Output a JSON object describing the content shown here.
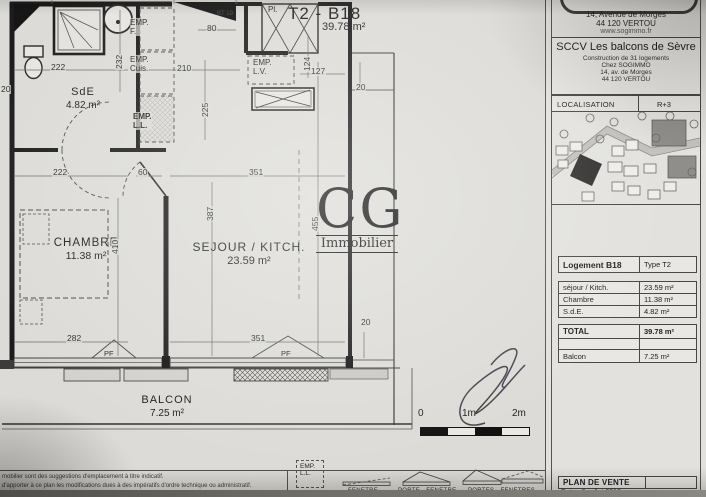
{
  "plan": {
    "title": "T2 - B18",
    "title_area": "39.78 m²",
    "rooms": {
      "sde_name": "SdE",
      "sde_area": "4.82 m²",
      "chambre_name": "CHAMBRE",
      "chambre_area": "11.38 m²",
      "sejour_name": "SEJOUR / KITCH.",
      "sejour_area": "23.59 m²",
      "balcon_name": "BALCON",
      "balcon_area": "7.25 m²"
    },
    "annotations": {
      "emp_f": "EMP.\nF.",
      "emp_cuis": "EMP.\nCuis.",
      "emp_ll": "EMP.\nL.L.",
      "emp_lv": "EMP.\nL.V.",
      "placard": "Pl.",
      "door_tag": "BT 19",
      "pf1": "PF",
      "pf2": "PF"
    },
    "dims": [
      {
        "t": "222",
        "x": 50,
        "y": 63
      },
      {
        "t": "210",
        "x": 176,
        "y": 64
      },
      {
        "t": "80",
        "x": 206,
        "y": 24
      },
      {
        "t": "225",
        "x": 201,
        "y": 118,
        "r": 1
      },
      {
        "t": "127",
        "x": 310,
        "y": 67
      },
      {
        "t": "124",
        "x": 303,
        "y": 72,
        "r": 1
      },
      {
        "t": "232",
        "x": 115,
        "y": 70,
        "r": 1
      },
      {
        "t": "20",
        "x": 0,
        "y": 85
      },
      {
        "t": "222",
        "x": 52,
        "y": 168
      },
      {
        "t": "60",
        "x": 137,
        "y": 168
      },
      {
        "t": "351",
        "x": 248,
        "y": 168
      },
      {
        "t": "410",
        "x": 111,
        "y": 255,
        "r": 1
      },
      {
        "t": "387",
        "x": 206,
        "y": 222,
        "r": 1
      },
      {
        "t": "455",
        "x": 311,
        "y": 232,
        "r": 1
      },
      {
        "t": "282",
        "x": 66,
        "y": 334
      },
      {
        "t": "351",
        "x": 250,
        "y": 334
      },
      {
        "t": "20",
        "x": 355,
        "y": 83
      },
      {
        "t": "20",
        "x": 360,
        "y": 318
      }
    ],
    "watermark": {
      "initials": "CG",
      "name": "Immobilier"
    },
    "scale": {
      "t0": "0",
      "t1": "1m",
      "t2": "2m"
    },
    "legend": {
      "emp": "EMP.\nL.L.",
      "items": [
        {
          "label": "FENETRE"
        },
        {
          "label": "PORTE - FENETRE"
        },
        {
          "label": "PORTES - FENETRES"
        }
      ]
    },
    "disclaimer": {
      "line1": "mobilier sont des suggestions d'emplacement à titre indicatif.",
      "line2": "d'apporter à ce plan les modifications dues à des impératifs d'ordre technique ou administratif."
    }
  },
  "titleblock": {
    "agency": {
      "line1": "14, Avenue de Morges",
      "line2": "44 120 VERTOU",
      "website": "www.sogimmo.fr"
    },
    "project": {
      "name": "SCCV Les balcons de Sèvre",
      "line1": "Construction de 31 logements",
      "line2": "Chez SOGIMMO",
      "line3": "14, av. de Morges",
      "line4": "44 120 VERTOU"
    },
    "localisation": {
      "label": "LOCALISATION",
      "level": "R+3"
    },
    "table": {
      "unit": "Logement B18",
      "type": "Type T2",
      "rows": [
        {
          "label": "séjour / Kitch.",
          "value": "23.59 m²"
        },
        {
          "label": "Chambre",
          "value": "11.38 m²"
        },
        {
          "label": "S.d.E.",
          "value": "4.82 m²"
        }
      ],
      "total_label": "TOTAL",
      "total_value": "39.78 m²",
      "balcon_label": "Balcon",
      "balcon_value": "7.25 m²"
    },
    "footer": {
      "title": "PLAN DE VENTE",
      "date": "Date : 9 juillet 2012"
    }
  }
}
